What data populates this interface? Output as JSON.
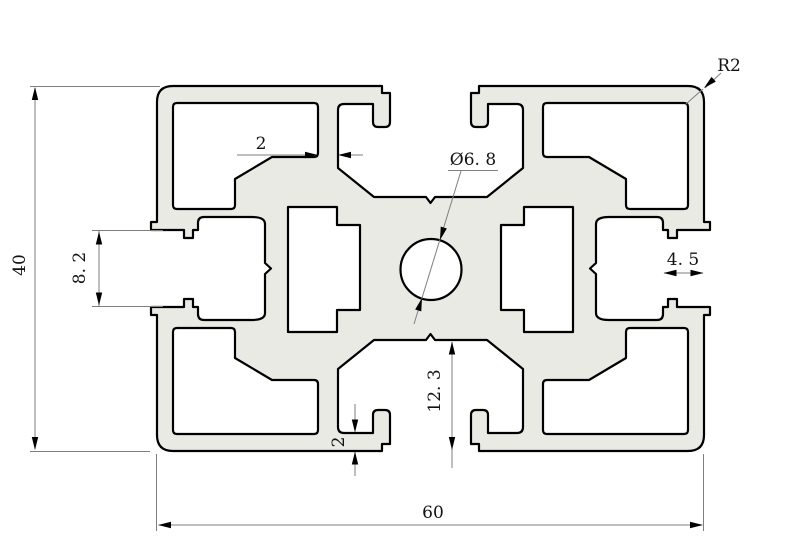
{
  "drawing": {
    "type": "technical-cad-cross-section",
    "subject": "aluminum extrusion profile 40x60 with T-slots and center bore",
    "colors": {
      "background": "#ffffff",
      "profile_fill": "#e9eae3",
      "outline": "#000000",
      "dimension_lines": "#7f7f7f",
      "text": "#121212"
    },
    "dimensions": {
      "overall_height": "40",
      "overall_width": "60",
      "top_web_thickness": "2",
      "center_hole_diameter": "Ø6. 8",
      "corner_radius": "R2",
      "side_lip_depth": "4. 5",
      "side_slot_opening": "8. 2",
      "bottom_chamber_height": "12. 3",
      "bottom_wall_thickness": "2"
    }
  }
}
